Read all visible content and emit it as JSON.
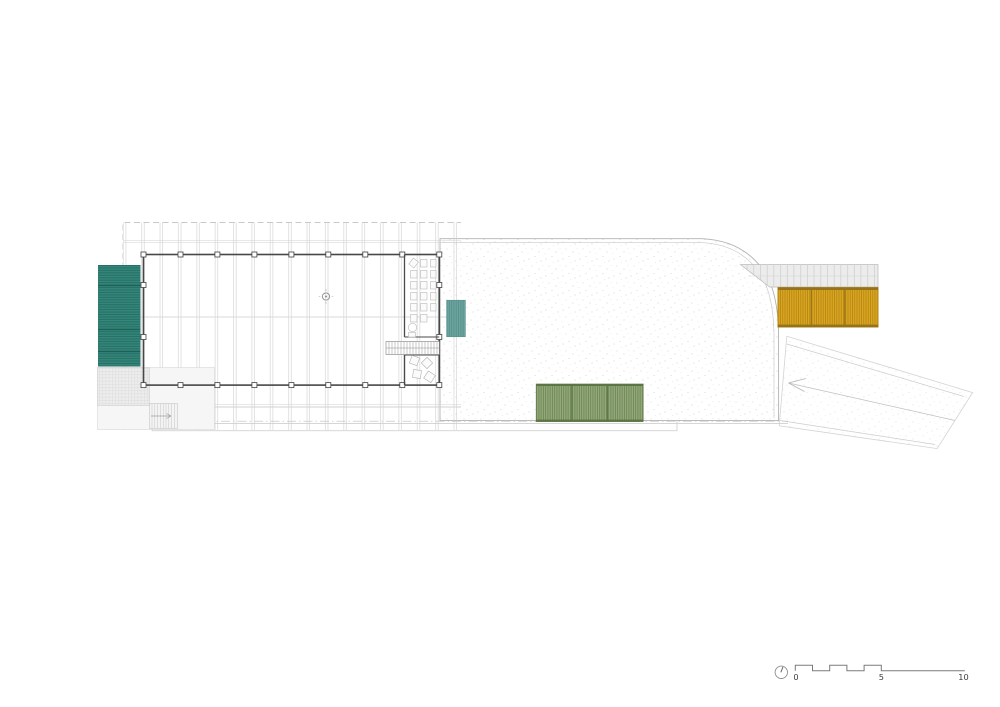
{
  "drawing": {
    "kind": "architectural roof plan",
    "background": "#ffffff"
  },
  "colors": {
    "teal_primary": "#35857a",
    "teal_primary_dark": "#1f6a5e",
    "teal_muted": "#6ba39f",
    "teal_muted_dark": "#538b86",
    "olive": "#94a87b",
    "olive_dark": "#6a8350",
    "olive_edge": "#5c7544",
    "yellow": "#d9a524",
    "yellow_dark": "#b9880f",
    "yellow_edge": "#96731a",
    "wall": "#474747",
    "grid_line": "#cbcbcb",
    "stipple_dot": "#c9c9c9"
  },
  "scale_bar": {
    "label_0": "0",
    "label_5": "5",
    "label_10": "10"
  },
  "icons": {
    "north_indicator": "north-indicator-icon"
  }
}
